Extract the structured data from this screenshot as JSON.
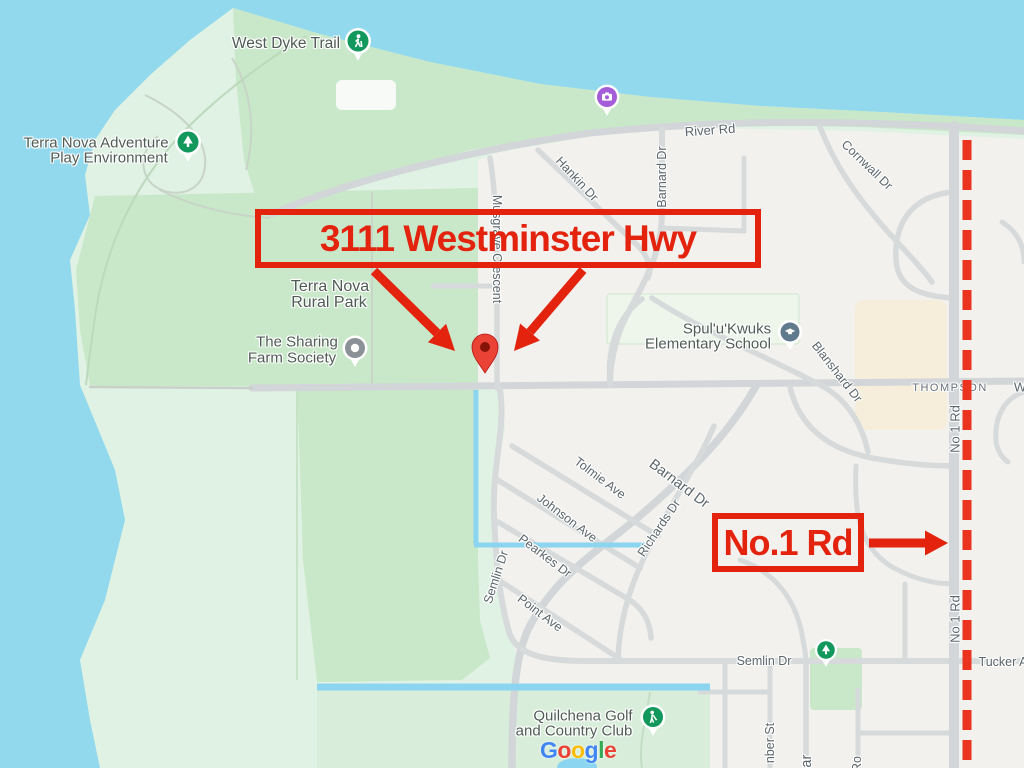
{
  "annotations": {
    "box1_label": "3111 Westminster Hwy",
    "box2_label": "No.1 Rd",
    "red": "#e3230e",
    "dashed_line_red": "#ea3420"
  },
  "map": {
    "colors": {
      "water": "#92d9ee",
      "parkland": "#e0f2e3",
      "park_green": "#c9e8c9",
      "golf_green": "#d8eeda",
      "urban": "#f2f1ee",
      "road": "#d7dadb",
      "commercial": "#f6eeda",
      "canal": "#8bd5f0"
    },
    "street_labels": [
      {
        "id": "river-rd",
        "text": "River Rd"
      },
      {
        "id": "cornwall-dr",
        "text": "Cornwall Dr"
      },
      {
        "id": "hankin-dr",
        "text": "Hankin Dr"
      },
      {
        "id": "barnard-dr-north",
        "text": "Barnard Dr"
      },
      {
        "id": "musgrave-crescent",
        "text": "Musgrave Crescent"
      },
      {
        "id": "blanshard-dr",
        "text": "Blanshard Dr"
      },
      {
        "id": "thompson",
        "text": "THOMPSON"
      },
      {
        "id": "no1-rd-upper",
        "text": "No 1 Rd"
      },
      {
        "id": "no1-rd-lower",
        "text": "No 1 Rd"
      },
      {
        "id": "tolmie-ave",
        "text": "Tolmie Ave"
      },
      {
        "id": "johnson-ave",
        "text": "Johnson Ave"
      },
      {
        "id": "pearkes-dr",
        "text": "Pearkes Dr"
      },
      {
        "id": "point-ave",
        "text": "Point Ave"
      },
      {
        "id": "richards-dr",
        "text": "Richards Dr"
      },
      {
        "id": "barnard-dr-south",
        "text": "Barnard Dr"
      },
      {
        "id": "semlin-dr-west",
        "text": "Semlin Dr"
      },
      {
        "id": "semlin-dr-east",
        "text": "Semlin Dr"
      },
      {
        "id": "tucker-ave",
        "text": "Tucker Av"
      },
      {
        "id": "nber-st",
        "text": "nber St"
      },
      {
        "id": "ba-street",
        "text": "Bar"
      },
      {
        "id": "ro-street",
        "text": "Ro"
      },
      {
        "id": "w-clipped",
        "text": "W"
      }
    ],
    "place_labels": [
      {
        "id": "west-dyke-trail",
        "lines": [
          "West Dyke Trail"
        ]
      },
      {
        "id": "terra-nova-adventure",
        "lines": [
          "Terra Nova Adventure",
          "Play Environment"
        ]
      },
      {
        "id": "terra-nova-rural-park",
        "lines": [
          "Terra Nova",
          "Rural Park"
        ]
      },
      {
        "id": "sharing-farm",
        "lines": [
          "The Sharing",
          "Farm Society"
        ]
      },
      {
        "id": "spulukwuks-school",
        "lines": [
          "Spul'u'Kwuks",
          "Elementary School"
        ]
      },
      {
        "id": "quilchena-golf",
        "lines": [
          "Quilchena Golf",
          "and Country Club"
        ]
      }
    ],
    "pins": [
      {
        "name": "trail-pin",
        "color": "#12975c"
      },
      {
        "name": "adventure-tree-pin",
        "color": "#12975c"
      },
      {
        "name": "photo-pin",
        "color": "#a55cd9"
      },
      {
        "name": "farm-pin",
        "color": "#8a9197"
      },
      {
        "name": "school-pin",
        "color": "#5f7a8c"
      },
      {
        "name": "destination-marker",
        "color": "#ea4335"
      },
      {
        "name": "golf-pin",
        "color": "#12975c"
      },
      {
        "name": "park-tree-pin",
        "color": "#12975c"
      }
    ],
    "google_logo": {
      "letters": [
        {
          "ch": "G",
          "color": "#4285F4"
        },
        {
          "ch": "o",
          "color": "#EA4335"
        },
        {
          "ch": "o",
          "color": "#FBBC05"
        },
        {
          "ch": "g",
          "color": "#4285F4"
        },
        {
          "ch": "l",
          "color": "#34A853"
        },
        {
          "ch": "e",
          "color": "#EA4335"
        }
      ]
    }
  }
}
